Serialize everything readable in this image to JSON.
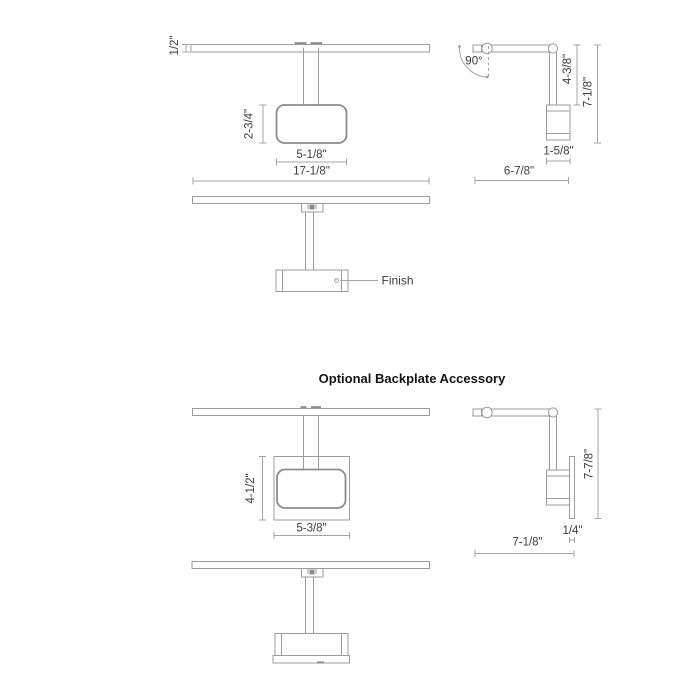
{
  "page": {
    "background": "#ffffff",
    "line_color": "#9b9b9b",
    "dim_line_color": "#a4a4a4",
    "text_color": "#3d3d3d",
    "title_color": "#141414"
  },
  "title": "Optional Backplate Accessory",
  "finish_label": "Finish",
  "fixture": {
    "front_view": {
      "bar_height": "1/2\"",
      "backplate_height": "2-3/4\"",
      "backplate_width": "5-1/8\"",
      "overall_width": "17-1/8\""
    },
    "side_view": {
      "swivel_angle": "90°",
      "arm_drop": "4-3/8\"",
      "overall_height": "7-1/8\"",
      "head_width": "1-5/8\"",
      "overall_depth": "6-7/8\""
    }
  },
  "backplate_accessory": {
    "front_view": {
      "backplate_height": "4-1/2\"",
      "backplate_width": "5-3/8\""
    },
    "side_view": {
      "overall_height": "7-7/8\"",
      "plate_thickness": "1/4\"",
      "overall_depth": "7-1/8\""
    }
  }
}
